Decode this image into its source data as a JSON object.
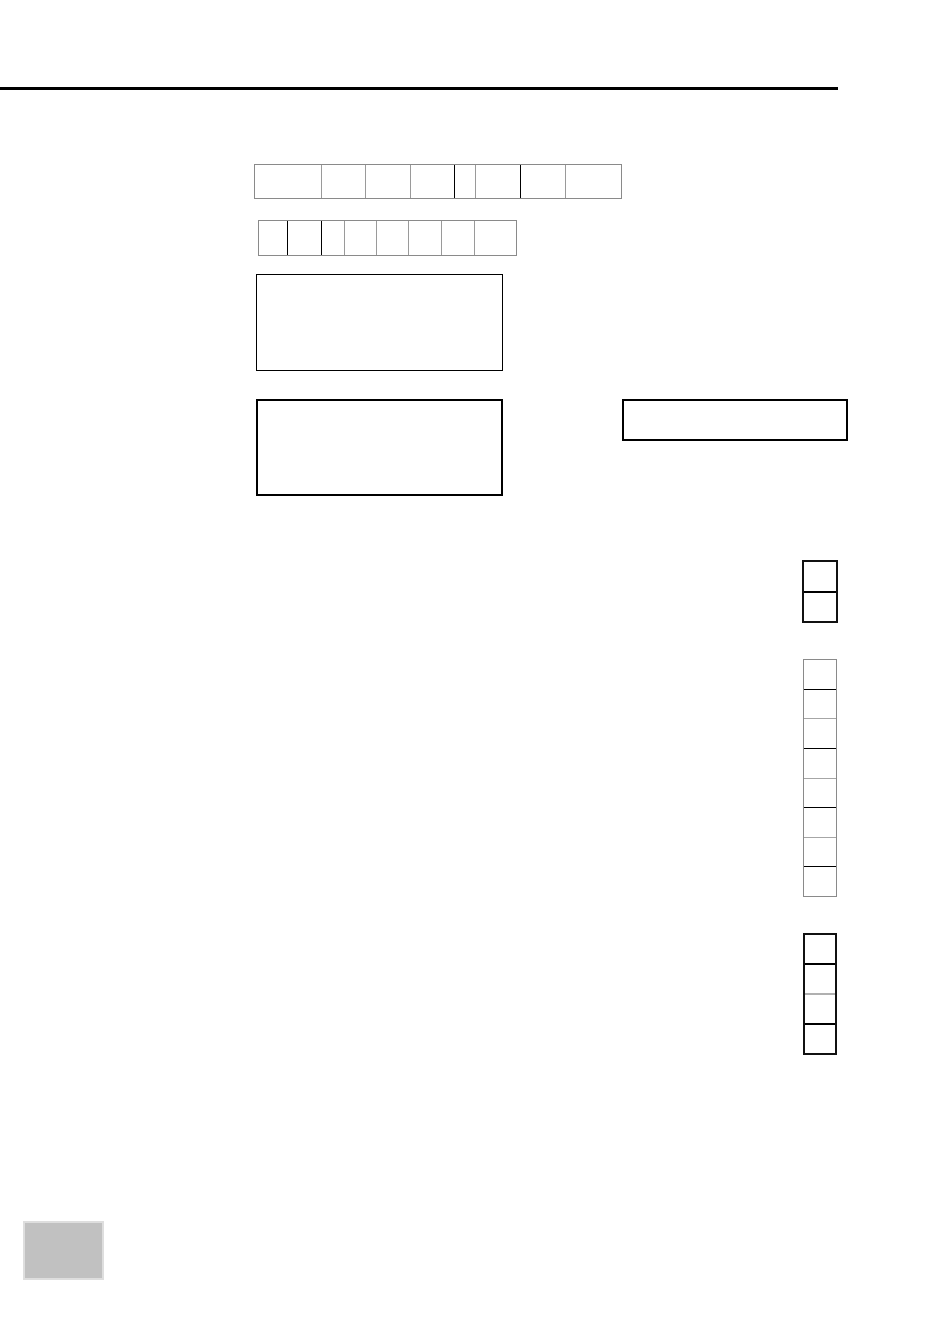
{
  "page": {
    "background_color": "#ffffff"
  },
  "header_rule": {
    "color": "#000000"
  },
  "grids": {
    "row_top": {
      "direction": "row",
      "outer_border_color": "#8a8a8a",
      "outer_border_width": "1px",
      "divider_width": "1px",
      "cell_sizes": [
        67,
        44,
        45,
        44,
        21,
        45,
        45,
        48
      ],
      "divider_colors": [
        "#9a9a9a",
        "#9a9a9a",
        "#9a9a9a",
        "#000000",
        "#9a9a9a",
        "#000000",
        "#9a9a9a"
      ]
    },
    "row_bottom": {
      "direction": "row",
      "outer_border_color": "#8a8a8a",
      "outer_border_width": "1px",
      "divider_width": "1px",
      "cell_sizes": [
        29,
        34,
        23,
        32,
        32,
        33,
        33,
        34
      ],
      "divider_colors": [
        "#000000",
        "#000000",
        "#9a9a9a",
        "#9a9a9a",
        "#9a9a9a",
        "#9a9a9a",
        "#9a9a9a"
      ]
    },
    "col_pair": {
      "direction": "column",
      "outer_border_color": "#111111",
      "outer_border_width": "2px",
      "divider_width": "2px",
      "cell_sizes": 2,
      "divider_colors": [
        "#000000"
      ]
    },
    "col_eight": {
      "direction": "column",
      "outer_border_color": "#8a8a8a",
      "outer_border_width": "1px",
      "divider_width": "1px",
      "cell_sizes": 8,
      "divider_colors": [
        "#000000",
        "#a6a6a6",
        "#000000",
        "#a6a6a6",
        "#000000",
        "#a6a6a6",
        "#000000"
      ]
    },
    "col_four": {
      "direction": "column",
      "outer_border_color": "#111111",
      "outer_border_width": "2px",
      "divider_width": "2px",
      "cell_sizes": 4,
      "divider_colors": [
        "#000000",
        "#b0b0b0",
        "#000000"
      ]
    }
  },
  "outline_boxes": {
    "large_upper": {
      "border_color": "#000000"
    },
    "large_lower": {
      "border_color": "#000000"
    },
    "wide_right": {
      "border_color": "#000000"
    }
  },
  "footer_swatch": {
    "fill_color": "#c1c1c1",
    "border_color": "#dedede"
  }
}
